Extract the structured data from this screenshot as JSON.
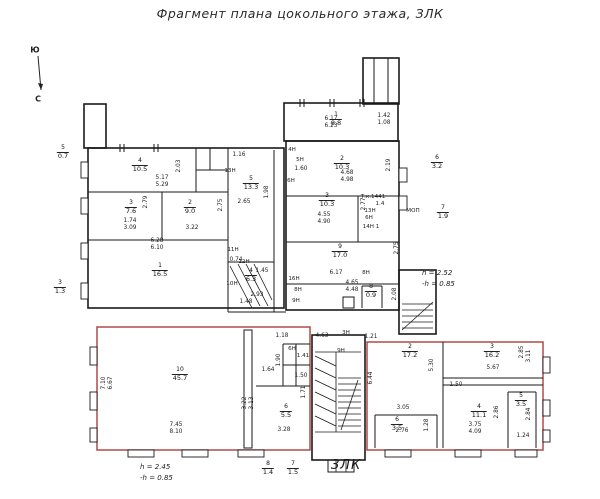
{
  "title": "Фрагмент плана  цокольного этажа, ЗЛК",
  "zlk_label": "ЗЛК",
  "colors": {
    "wall": "#1a1a1a",
    "red_outline": "#b04a4a",
    "text": "#222222"
  },
  "plan": {
    "note_left": {
      "l1": "h = 2.45",
      "l2": "-h = 0.85"
    },
    "note_right": {
      "l1": "h = 2.52",
      "l2": "-h = 0.85"
    },
    "compass": {
      "south": "Ю",
      "north": "С"
    },
    "rooms": [
      {
        "num": "4",
        "area": "10.5",
        "x": 140,
        "y": 158
      },
      {
        "num": "3",
        "area": "7.6",
        "x": 131,
        "y": 200
      },
      {
        "num": "2",
        "area": "9.0",
        "x": 190,
        "y": 200
      },
      {
        "num": "5",
        "area": "13.3",
        "x": 251,
        "y": 176
      },
      {
        "num": "1",
        "area": "16.5",
        "x": 160,
        "y": 263
      },
      {
        "num": "4",
        "area": "6.3",
        "x": 251,
        "y": 268
      },
      {
        "num": "1",
        "area": "8.8",
        "x": 336,
        "y": 112
      },
      {
        "num": "2",
        "area": "10.3",
        "x": 342,
        "y": 156
      },
      {
        "num": "3",
        "area": "10.3",
        "x": 327,
        "y": 193
      },
      {
        "num": "9",
        "area": "17.0",
        "x": 340,
        "y": 244
      },
      {
        "num": "8",
        "area": "0.9",
        "x": 371,
        "y": 284
      },
      {
        "num": "10",
        "area": "45.7",
        "x": 180,
        "y": 367
      },
      {
        "num": "2",
        "area": "17.2",
        "x": 410,
        "y": 344
      },
      {
        "num": "3",
        "area": "16.2",
        "x": 492,
        "y": 344
      },
      {
        "num": "4",
        "area": "11.1",
        "x": 479,
        "y": 404
      },
      {
        "num": "5",
        "area": "3.5",
        "x": 521,
        "y": 393
      },
      {
        "num": "6",
        "area": "3.5",
        "x": 397,
        "y": 417
      },
      {
        "num": "6",
        "area": "5.5",
        "x": 286,
        "y": 404
      },
      {
        "num": "5",
        "area": "0.7",
        "x": 63,
        "y": 145
      },
      {
        "num": "3",
        "area": "1.3",
        "x": 60,
        "y": 280
      },
      {
        "num": "6",
        "area": "3.2",
        "x": 437,
        "y": 155
      },
      {
        "num": "7",
        "area": "1.9",
        "x": 443,
        "y": 205
      },
      {
        "num": "8",
        "area": "1.4",
        "x": 268,
        "y": 461
      },
      {
        "num": "7",
        "area": "1.5",
        "x": 293,
        "y": 461
      }
    ],
    "dims": [
      {
        "t": "5.17",
        "x": 162,
        "y": 178
      },
      {
        "t": "5.29",
        "x": 162,
        "y": 185
      },
      {
        "t": "2.03",
        "x": 179,
        "y": 166,
        "r": 1
      },
      {
        "t": "2.79",
        "x": 146,
        "y": 202,
        "r": 1
      },
      {
        "t": "1.74",
        "x": 130,
        "y": 221
      },
      {
        "t": "3.09",
        "x": 130,
        "y": 228
      },
      {
        "t": "3.22",
        "x": 192,
        "y": 228
      },
      {
        "t": "2.75",
        "x": 221,
        "y": 205,
        "r": 1
      },
      {
        "t": "6.28",
        "x": 157,
        "y": 241
      },
      {
        "t": "6.10",
        "x": 157,
        "y": 248
      },
      {
        "t": "1.16",
        "x": 239,
        "y": 155
      },
      {
        "t": "2.65",
        "x": 244,
        "y": 202
      },
      {
        "t": "1.98",
        "x": 267,
        "y": 192,
        "r": 1
      },
      {
        "t": "0.74",
        "x": 236,
        "y": 260
      },
      {
        "t": "6.17",
        "x": 331,
        "y": 119
      },
      {
        "t": "6.23",
        "x": 331,
        "y": 126
      },
      {
        "t": "1.42",
        "x": 384,
        "y": 116
      },
      {
        "t": "1.08",
        "x": 384,
        "y": 123
      },
      {
        "t": "4.68",
        "x": 347,
        "y": 173
      },
      {
        "t": "4.98",
        "x": 347,
        "y": 180
      },
      {
        "t": "2.19",
        "x": 389,
        "y": 165,
        "r": 1
      },
      {
        "t": "4.55",
        "x": 324,
        "y": 215
      },
      {
        "t": "4.90",
        "x": 324,
        "y": 222
      },
      {
        "t": "2.77",
        "x": 364,
        "y": 204,
        "r": 1
      },
      {
        "t": "1.60",
        "x": 301,
        "y": 169
      },
      {
        "t": "2.75",
        "x": 397,
        "y": 248,
        "r": 1
      },
      {
        "t": "6.17",
        "x": 336,
        "y": 273
      },
      {
        "t": "4.65",
        "x": 352,
        "y": 283
      },
      {
        "t": "4.48",
        "x": 352,
        "y": 290
      },
      {
        "t": "2.08",
        "x": 395,
        "y": 294,
        "r": 1
      },
      {
        "t": "4.63",
        "x": 322,
        "y": 336
      },
      {
        "t": "1.21",
        "x": 371,
        "y": 337
      },
      {
        "t": "7.10",
        "x": 104,
        "y": 383,
        "r": 1
      },
      {
        "t": "6.67",
        "x": 111,
        "y": 383,
        "r": 1
      },
      {
        "t": "7.45",
        "x": 176,
        "y": 425
      },
      {
        "t": "8.10",
        "x": 176,
        "y": 432
      },
      {
        "t": "1.18",
        "x": 282,
        "y": 336
      },
      {
        "t": "1.64",
        "x": 268,
        "y": 370
      },
      {
        "t": "1.90",
        "x": 279,
        "y": 360,
        "r": 1
      },
      {
        "t": "1.50",
        "x": 301,
        "y": 376
      },
      {
        "t": "1.71",
        "x": 304,
        "y": 392,
        "r": 1
      },
      {
        "t": "3.22",
        "x": 245,
        "y": 403,
        "r": 1
      },
      {
        "t": "3.13",
        "x": 252,
        "y": 403,
        "r": 1
      },
      {
        "t": "3.28",
        "x": 284,
        "y": 430
      },
      {
        "t": "6.44",
        "x": 371,
        "y": 378,
        "r": 1
      },
      {
        "t": "5.30",
        "x": 432,
        "y": 365,
        "r": 1
      },
      {
        "t": "3.05",
        "x": 403,
        "y": 408
      },
      {
        "t": "2.76",
        "x": 402,
        "y": 431
      },
      {
        "t": "1.28",
        "x": 427,
        "y": 425,
        "r": 1
      },
      {
        "t": "5.67",
        "x": 493,
        "y": 368
      },
      {
        "t": "2.85",
        "x": 522,
        "y": 352,
        "r": 1
      },
      {
        "t": "3.11",
        "x": 529,
        "y": 356,
        "r": 1
      },
      {
        "t": "1.50",
        "x": 456,
        "y": 385
      },
      {
        "t": "2.86",
        "x": 497,
        "y": 412,
        "r": 1
      },
      {
        "t": "3.75",
        "x": 475,
        "y": 425
      },
      {
        "t": "4.09",
        "x": 475,
        "y": 432
      },
      {
        "t": "2.84",
        "x": 529,
        "y": 414,
        "r": 1
      },
      {
        "t": "1.24",
        "x": 523,
        "y": 436
      },
      {
        "t": "1.45",
        "x": 262,
        "y": 271
      },
      {
        "t": "2.93",
        "x": 257,
        "y": 295
      },
      {
        "t": "1.48",
        "x": 246,
        "y": 302
      }
    ],
    "notes": [
      {
        "t": "Ю",
        "x": 35,
        "y": 50,
        "c": "compass"
      },
      {
        "t": "С",
        "x": 38,
        "y": 99,
        "c": "compass"
      },
      {
        "t": "13Н",
        "x": 230,
        "y": 171
      },
      {
        "t": "4Н",
        "x": 292,
        "y": 150
      },
      {
        "t": "5Н",
        "x": 300,
        "y": 160
      },
      {
        "t": "6Н",
        "x": 291,
        "y": 181
      },
      {
        "t": "Т.к.1441",
        "x": 373,
        "y": 197
      },
      {
        "t": "1.4",
        "x": 380,
        "y": 204
      },
      {
        "t": "13Н",
        "x": 370,
        "y": 211
      },
      {
        "t": "6Н",
        "x": 369,
        "y": 218
      },
      {
        "t": "14Н 1",
        "x": 371,
        "y": 227
      },
      {
        "t": "8Н",
        "x": 366,
        "y": 273
      },
      {
        "t": "16Н",
        "x": 294,
        "y": 279
      },
      {
        "t": "8Н",
        "x": 298,
        "y": 290
      },
      {
        "t": "9Н",
        "x": 296,
        "y": 301
      },
      {
        "t": "12Н",
        "x": 244,
        "y": 262
      },
      {
        "t": "11Н",
        "x": 233,
        "y": 250
      },
      {
        "t": "10Н",
        "x": 232,
        "y": 284
      },
      {
        "t": "МОП",
        "x": 413,
        "y": 211
      },
      {
        "t": "3Н",
        "x": 346,
        "y": 333
      },
      {
        "t": "9Н",
        "x": 341,
        "y": 351
      },
      {
        "t": "6Н",
        "x": 292,
        "y": 349
      },
      {
        "t": "1.41",
        "x": 303,
        "y": 356
      }
    ]
  }
}
